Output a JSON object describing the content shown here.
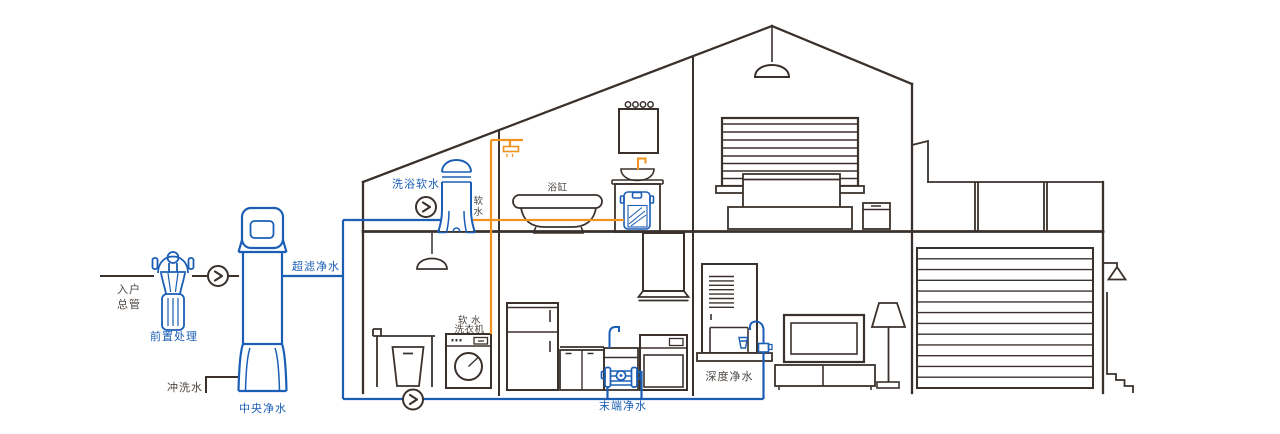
{
  "diagram": {
    "type": "house-whole-home-water-purification-cutaway",
    "labels": {
      "inlet_line1": "入户",
      "inlet_line2": "总管",
      "prefilter": "前置处理",
      "flush_water": "冲洗水",
      "central_purifier": "中央净水",
      "ultrafiltration": "超滤净水",
      "bath_softener": "洗浴软水",
      "soft_water_char1": "软",
      "soft_water_char2": "水",
      "bathtub": "浴缸",
      "soft_washer_line1": "软 水",
      "soft_washer_line2": "洗衣机",
      "terminal_purifier": "末端净水",
      "deep_purifier": "深度净水"
    },
    "colors": {
      "line_dark": "#3a312c",
      "pipe_blue": "#1b5eb5",
      "pipe_orange": "#f0921e",
      "text_dark": "#4d4742",
      "background": "#ffffff"
    }
  }
}
